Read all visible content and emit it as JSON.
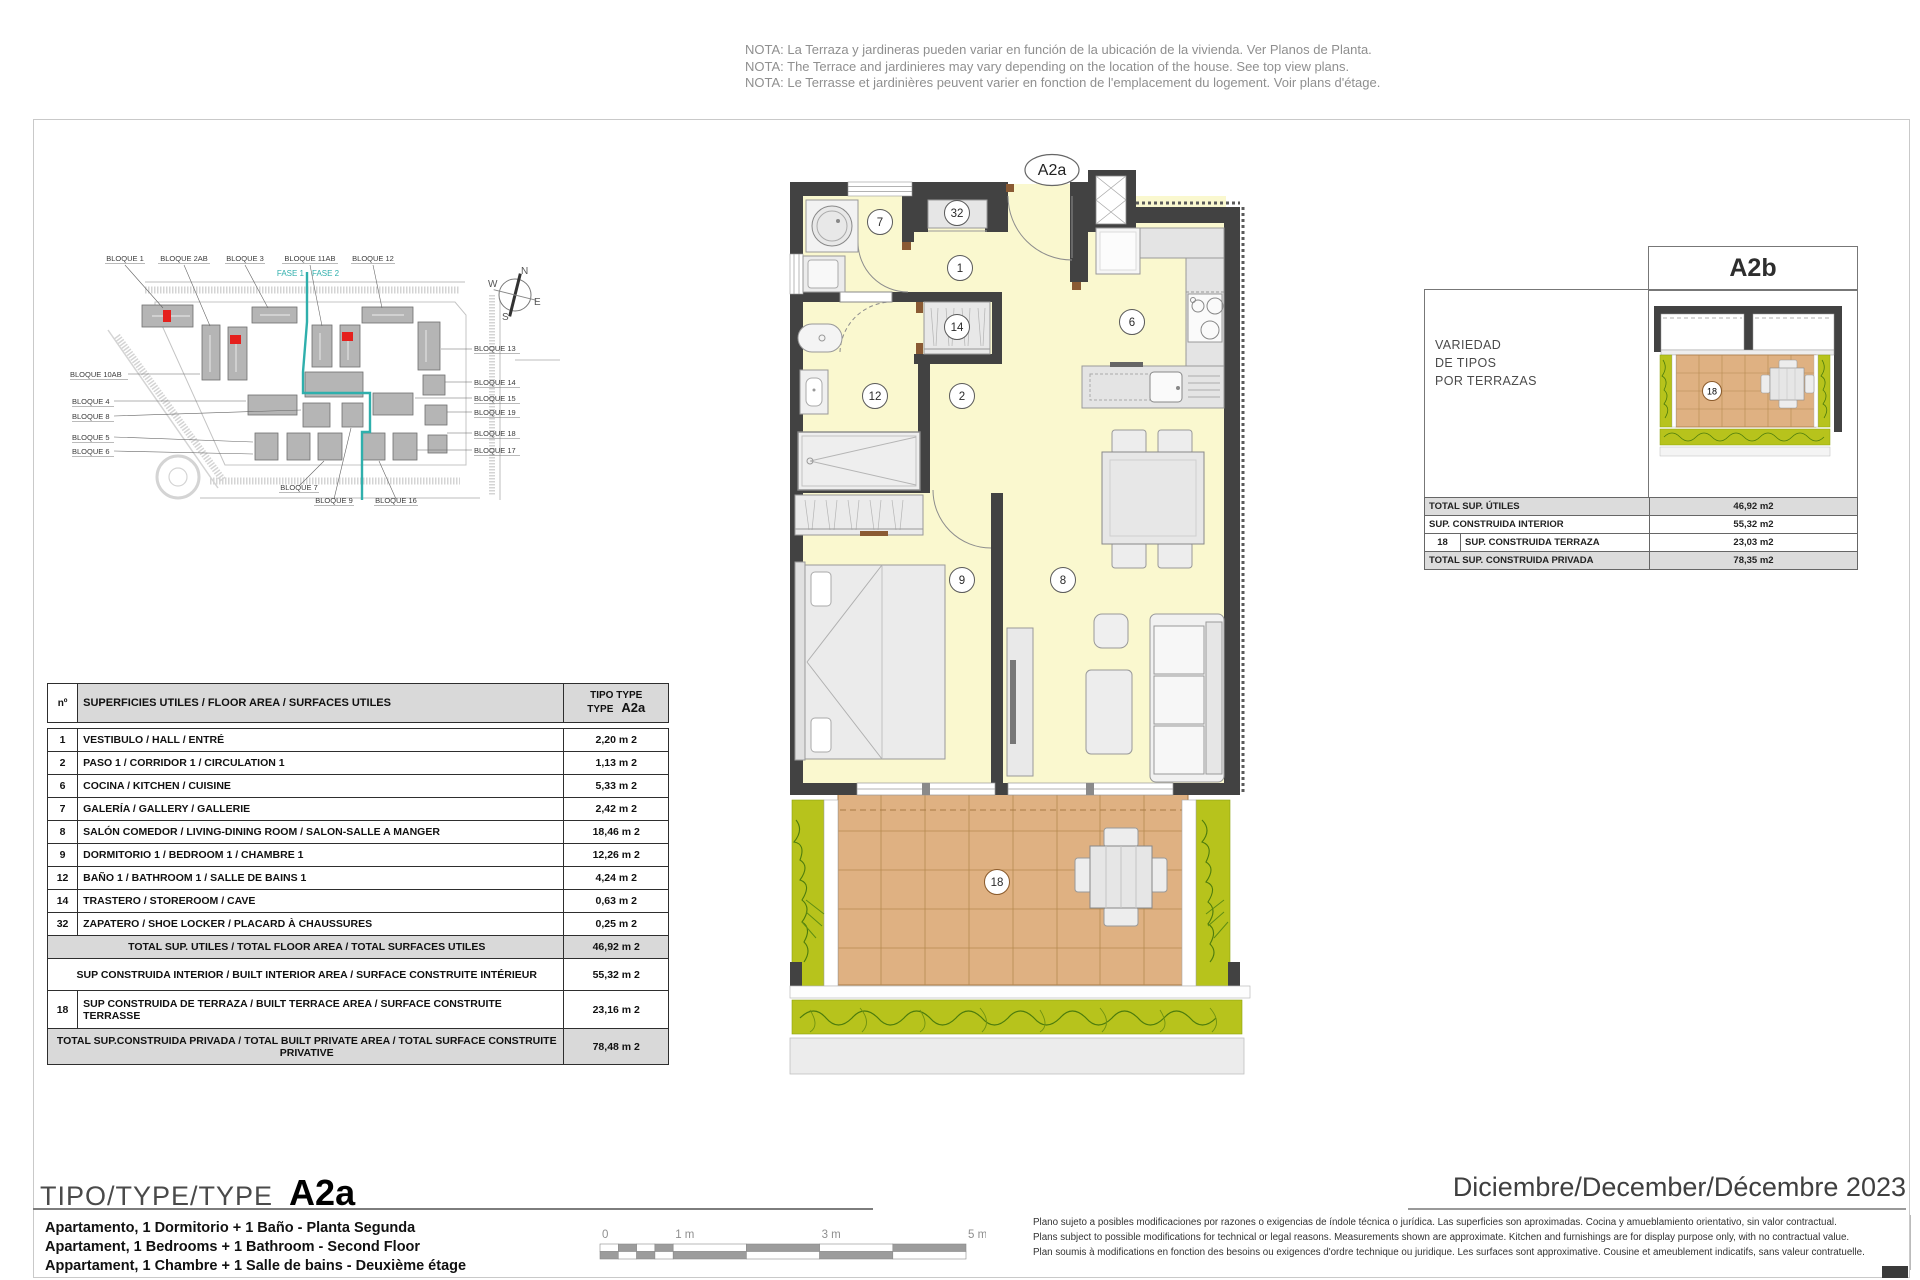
{
  "notes": {
    "lines": [
      "NOTA: La Terraza y jardineras pueden variar en función de la ubicación de la vivienda. Ver Planos de Planta.",
      "NOTA: The Terrace and jardinieres may vary depending on the location of the house. See top view plans.",
      "NOTA: Le Terrasse et jardinières peuvent varier en fonction de l'emplacement du logement. Voir plans d'étage."
    ]
  },
  "site_plan": {
    "fase1": "FASE 1",
    "fase2": "FASE 2",
    "compass": {
      "n": "N",
      "s": "S",
      "e": "E",
      "w": "W"
    },
    "labels": [
      {
        "t": "BLOQUE 1",
        "x": 65,
        "y": 21,
        "a": "middle",
        "w": 40
      },
      {
        "t": "BLOQUE 2AB",
        "x": 124,
        "y": 21,
        "a": "middle",
        "w": 52
      },
      {
        "t": "BLOQUE 3",
        "x": 185,
        "y": 21,
        "a": "middle",
        "w": 40
      },
      {
        "t": "BLOQUE 11AB",
        "x": 250,
        "y": 21,
        "a": "middle",
        "w": 56
      },
      {
        "t": "BLOQUE 12",
        "x": 313,
        "y": 21,
        "a": "middle",
        "w": 44
      },
      {
        "t": "BLOQUE 10AB",
        "x": 10,
        "y": 137,
        "a": "start",
        "w": 58
      },
      {
        "t": "BLOQUE 4",
        "x": 12,
        "y": 164,
        "a": "start",
        "w": 42
      },
      {
        "t": "BLOQUE 8",
        "x": 12,
        "y": 179,
        "a": "start",
        "w": 42
      },
      {
        "t": "BLOQUE 5",
        "x": 12,
        "y": 200,
        "a": "start",
        "w": 42
      },
      {
        "t": "BLOQUE 6",
        "x": 12,
        "y": 214,
        "a": "start",
        "w": 42
      },
      {
        "t": "BLOQUE 13",
        "x": 414,
        "y": 111,
        "a": "start",
        "w": 46
      },
      {
        "t": "BLOQUE 14",
        "x": 414,
        "y": 145,
        "a": "start",
        "w": 46
      },
      {
        "t": "BLOQUE 15",
        "x": 414,
        "y": 161,
        "a": "start",
        "w": 46
      },
      {
        "t": "BLOQUE 19",
        "x": 414,
        "y": 175,
        "a": "start",
        "w": 46
      },
      {
        "t": "BLOQUE 18",
        "x": 414,
        "y": 196,
        "a": "start",
        "w": 46
      },
      {
        "t": "BLOQUE 17",
        "x": 414,
        "y": 213,
        "a": "start",
        "w": 46
      },
      {
        "t": "BLOQUE 7",
        "x": 239,
        "y": 250,
        "a": "middle",
        "w": 40
      },
      {
        "t": "BLOQUE 9",
        "x": 274,
        "y": 263,
        "a": "middle",
        "w": 40
      },
      {
        "t": "BLOQUE 16",
        "x": 336,
        "y": 263,
        "a": "middle",
        "w": 44
      }
    ]
  },
  "floor_plan": {
    "unit_label": "A2a",
    "rooms": [
      {
        "n": "7",
        "x": 880,
        "y": 222
      },
      {
        "n": "32",
        "x": 957,
        "y": 213
      },
      {
        "n": "1",
        "x": 960,
        "y": 268
      },
      {
        "n": "14",
        "x": 957,
        "y": 327
      },
      {
        "n": "6",
        "x": 1132,
        "y": 322
      },
      {
        "n": "12",
        "x": 875,
        "y": 396
      },
      {
        "n": "2",
        "x": 962,
        "y": 396
      },
      {
        "n": "9",
        "x": 962,
        "y": 580
      },
      {
        "n": "8",
        "x": 1063,
        "y": 580
      },
      {
        "n": "18",
        "x": 997,
        "y": 882,
        "terrace": true
      }
    ]
  },
  "variants_panel": {
    "title": "A2b",
    "caption_lines": [
      "VARIEDAD",
      "DE TIPOS",
      "POR TERRAZAS"
    ],
    "terrace_number": "18",
    "rows": [
      {
        "num": "",
        "label": "TOTAL SUP. ÚTILES",
        "value": "46,92 m2",
        "shaded": true
      },
      {
        "num": "",
        "label": "SUP. CONSTRUIDA INTERIOR",
        "value": "55,32 m2",
        "shaded": false
      },
      {
        "num": "18",
        "label": "SUP. CONSTRUIDA TERRAZA",
        "value": "23,03 m2",
        "shaded": false
      },
      {
        "num": "",
        "label": "TOTAL SUP. CONSTRUIDA PRIVADA",
        "value": "78,35 m2",
        "shaded": true
      }
    ]
  },
  "areas_table": {
    "header": {
      "num": "nº",
      "label": "SUPERFICIES UTILES / FLOOR AREA / SURFACES UTILES",
      "type_line1": "TIPO TYPE",
      "type_line2": "TYPE",
      "type_code": "A2a"
    },
    "rows": [
      {
        "num": "1",
        "label": "VESTIBULO / HALL / ENTRÉ",
        "value": "2,20 m 2"
      },
      {
        "num": "2",
        "label": "PASO 1 / CORRIDOR 1 / CIRCULATION 1",
        "value": "1,13 m 2"
      },
      {
        "num": "6",
        "label": "COCINA / KITCHEN / CUISINE",
        "value": "5,33 m 2"
      },
      {
        "num": "7",
        "label": "GALERÍA / GALLERY / GALLERIE",
        "value": "2,42 m 2"
      },
      {
        "num": "8",
        "label": "SALÓN COMEDOR  / LIVING-DINING ROOM / SALON-SALLE A MANGER",
        "value": "18,46 m 2"
      },
      {
        "num": "9",
        "label": "DORMITORIO 1 / BEDROOM 1 / CHAMBRE 1",
        "value": "12,26 m 2"
      },
      {
        "num": "12",
        "label": "BAÑO 1 / BATHROOM 1 / SALLE DE BAINS 1",
        "value": "4,24 m 2"
      },
      {
        "num": "14",
        "label": "TRASTERO / STOREROOM / CAVE",
        "value": "0,63 m 2"
      },
      {
        "num": "32",
        "label": "ZAPATERO / SHOE LOCKER / PLACARD À CHAUSSURES",
        "value": "0,25 m 2"
      }
    ],
    "totals": [
      {
        "num": "",
        "label": "TOTAL SUP. UTILES / TOTAL FLOOR AREA / TOTAL SURFACES UTILES",
        "value": "46,92 m 2",
        "shaded": true,
        "center": true,
        "h": 20
      },
      {
        "num": "",
        "label": "SUP CONSTRUIDA INTERIOR / BUILT INTERIOR AREA /  SURFACE CONSTRUITE INTÉRIEUR",
        "value": "55,32 m 2",
        "shaded": false,
        "center": true,
        "h": 32
      },
      {
        "num": "18",
        "label": "SUP CONSTRUIDA DE TERRAZA  / BUILT TERRACE AREA / SURFACE CONSTRUITE TERRASSE",
        "value": "23,16 m 2",
        "shaded": false,
        "center": false,
        "h": 38
      },
      {
        "num": "",
        "label": "TOTAL SUP.CONSTRUIDA PRIVADA / TOTAL  BUILT PRIVATE AREA / TOTAL SURFACE CONSTRUITE PRIVATIVE",
        "value": "78,48 m 2",
        "shaded": true,
        "center": true,
        "h": 36
      }
    ]
  },
  "footer": {
    "type_prefix": "TIPO/TYPE/TYPE",
    "type_code": "A2a",
    "descriptions": [
      "Apartamento, 1 Dormitorio + 1 Baño - Planta Segunda",
      "Apartament, 1 Bedrooms + 1 Bathroom - Second Floor",
      "Appartament, 1 Chambre + 1 Salle de bains - Deuxième étage"
    ],
    "date": "Diciembre/December/Décembre 2023",
    "disclaimer": [
      "Plano sujeto a posibles modificaciones por razones o exigencias de índole técnica o jurídica. Las superficies son aproximadas. Cocina y amueblamiento orientativo, sin valor contractual.",
      "Plans subject to possible modifications for technical or legal reasons. Measurements shown are approximate. Kitchen and furnishings are for display purpose only, with no contractual value.",
      "Plan soumis à modifications en fonction des besoins ou exigences d'ordre technique ou juridique. Les surfaces sont approximative. Cousine et ameublement indicatifs, sans valeur contratuelle."
    ],
    "scale": {
      "labels": [
        {
          "t": "0",
          "m": 0
        },
        {
          "t": "1 m",
          "m": 1
        },
        {
          "t": "3 m",
          "m": 3
        },
        {
          "t": "5 m",
          "m": 5
        }
      ]
    }
  },
  "colors": {
    "wall": "#424242",
    "floor": "#FAF8CF",
    "terrace_tile": "#DFB182",
    "terrace_grid": "#B68A50",
    "planter": "#B7C31C",
    "plant_stroke": "#4C7C0D",
    "fase_teal": "#2FAFAC",
    "highlight_red": "#E5201D",
    "table_shade": "#D9D9D9"
  }
}
